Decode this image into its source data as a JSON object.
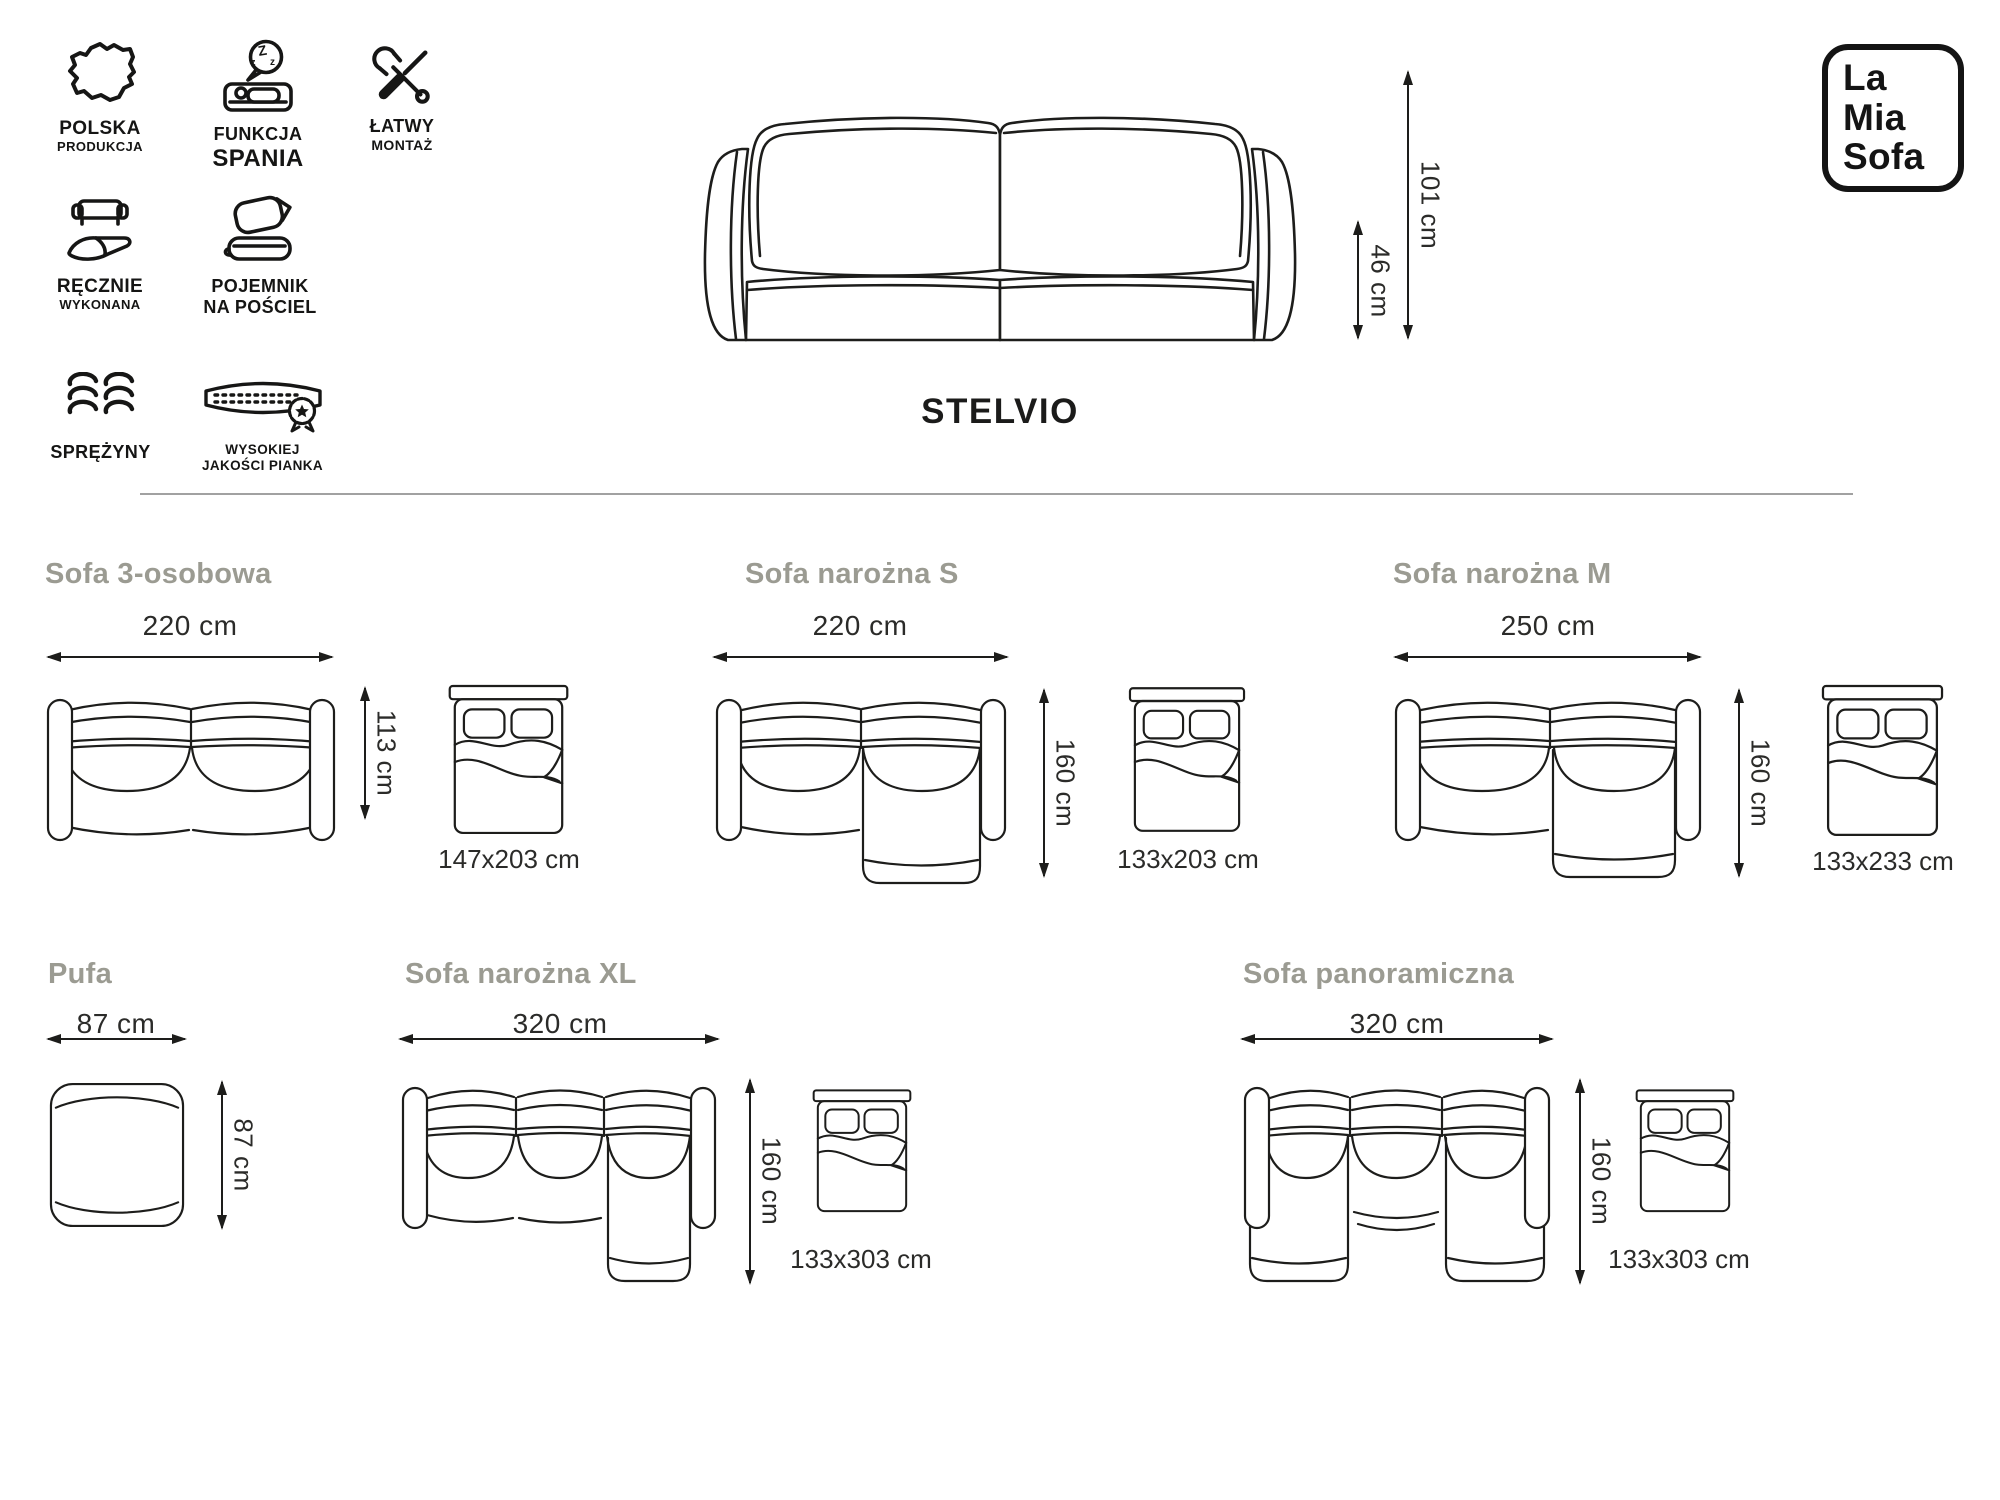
{
  "brand": {
    "line1": "La",
    "line2": "Mia",
    "line3": "Sofa"
  },
  "product": {
    "name": "STELVIO",
    "total_height": "101 cm",
    "seat_height": "46 cm"
  },
  "features": [
    {
      "icon": "poland-map-icon",
      "line1": "POLSKA",
      "line2": "PRODUKCJA"
    },
    {
      "icon": "sleep-function-icon",
      "line1": "FUNKCJA",
      "line2": "SPANIA"
    },
    {
      "icon": "easy-assembly-icon",
      "line1": "ŁATWY",
      "line2": "MONTAŻ"
    },
    {
      "icon": "handmade-icon",
      "line1": "RĘCZNIE",
      "line2": "WYKONANA"
    },
    {
      "icon": "bedding-container-icon",
      "line1": "POJEMNIK",
      "line2": "NA POŚCIEL"
    },
    {
      "icon": "springs-icon",
      "line1": "SPRĘŻYNY",
      "line2": ""
    },
    {
      "icon": "foam-quality-icon",
      "line1": "WYSOKIEJ",
      "line2": "JAKOŚCI PIANKA"
    }
  ],
  "variants": [
    {
      "name": "Sofa 3-osobowa",
      "width": "220 cm",
      "depth": "113 cm",
      "bed": "147x203 cm"
    },
    {
      "name": "Sofa narożna S",
      "width": "220 cm",
      "depth": "160 cm",
      "bed": "133x203 cm"
    },
    {
      "name": "Sofa narożna M",
      "width": "250 cm",
      "depth": "160 cm",
      "bed": "133x233 cm"
    },
    {
      "name": "Pufa",
      "width": "87 cm",
      "depth": "87 cm"
    },
    {
      "name": "Sofa narożna XL",
      "width": "320 cm",
      "depth": "160 cm",
      "bed": "133x303 cm"
    },
    {
      "name": "Sofa panoramiczna",
      "width": "320 cm",
      "depth": "160 cm",
      "bed": "133x303 cm"
    }
  ],
  "colors": {
    "line": "#1d1d1b",
    "heading": "#9b9b92",
    "text": "#2b2b29",
    "background": "#ffffff"
  }
}
